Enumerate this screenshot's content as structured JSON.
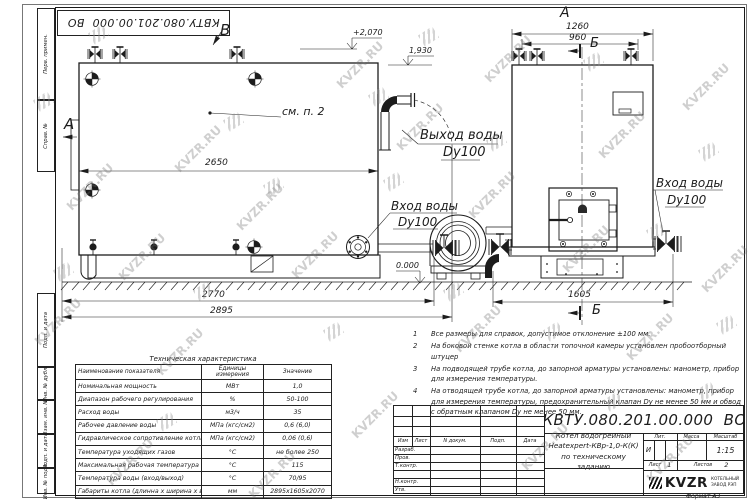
{
  "doc": {
    "number": "КВТУ.080.201.00.000  ВО",
    "format": "Формат  А3"
  },
  "watermark": {
    "text": "KVZR.RU"
  },
  "margin_labels": [
    "Перв. примен.",
    "Справ. №",
    "Подп. и дата",
    "Инв. № дубл.",
    "Взам. инв. №",
    "Подп. и дата",
    "Инв. № подл."
  ],
  "views": {
    "label_a_side": "А",
    "label_b_top": "B",
    "label_a_title": "А",
    "section_b": "Б",
    "see_note": "см. п. 2",
    "outlet": {
      "l1": "Выход воды",
      "l2": "Dy100"
    },
    "inlet_left": {
      "l1": "Вход воды",
      "l2": "Dy100"
    },
    "inlet_right": {
      "l1": "Вход воды",
      "l2": "Dy100"
    },
    "dims": {
      "d2650": "2650",
      "d2770": "2770",
      "d2895": "2895",
      "d1260": "1260",
      "d960": "960",
      "d1605": "1605"
    },
    "elev": {
      "top": "+2,070",
      "roof": "1,930",
      "zero": "0.000"
    }
  },
  "notes": [
    {
      "num": "1",
      "text": "Все размеры для справок, допустимое отклонение  ±100 мм."
    },
    {
      "num": "2",
      "text": "На боковой стенке котла в области топочной камеры установлен пробоотборный штуцер"
    },
    {
      "num": "3",
      "text": "На  подводящей трубе котла, до запорной арматуры установлены: манометр, прибор для измерения температуры."
    },
    {
      "num": "4",
      "text": "На отводящей трубе котла, до запорной арматуры установлены: манометр, прибор для измерения температуры, предохранительный клапан Dу не менее 50 мм и обвод с обратным клапаном Dу не менее 50 мм."
    }
  ],
  "tech_table": {
    "title": "Техническая характеристика",
    "headers": [
      "Наименование показателя",
      "Единицы измерения",
      "Значение"
    ],
    "rows": [
      [
        "Номинальная мощность",
        "МВт",
        "1,0"
      ],
      [
        "Диапазон рабочего регулирования",
        "%",
        "50-100"
      ],
      [
        "Расход воды",
        "м3/ч",
        "35"
      ],
      [
        "Рабочее давление воды",
        "МПа (кгс/см2)",
        "0,6 (6,0)"
      ],
      [
        "Гидравлическое сопротивление котла",
        "МПа (кгс/см2)",
        "0,06 (0,6)"
      ],
      [
        "Температура уходящих газов",
        "°С",
        "не более 250"
      ],
      [
        "Максимальная рабочая температура воды",
        "°С",
        "115"
      ],
      [
        "Температура воды (вход/выход)",
        "°С",
        "70/95"
      ],
      [
        "Габариты котла (длинна х ширина х высота)",
        "мм",
        "2895х1605х2070"
      ]
    ]
  },
  "title_block": {
    "number": "КВТУ.080.201.00.000  ВО",
    "columns": [
      "Изм",
      "Лист",
      "N докум.",
      "Подп.",
      "Дата"
    ],
    "rows": [
      "Разраб.",
      "Пров.",
      "Т.контр.",
      "",
      "Н.контр.",
      "Утв."
    ],
    "name_lines": [
      "Котел водогрейный",
      "Heatexpert-КВр-1,0-К(К)",
      "по техническому заданию"
    ],
    "lit_label": "Лит.",
    "lit_value": "И",
    "mass_label": "Масса",
    "scale_label": "Масштаб",
    "scale_value": "1:15",
    "sheet_label": "Лист",
    "sheet_value": "1",
    "sheets_label": "Листов",
    "sheets_value": "2",
    "company": "KVZR",
    "company_sub1": "КОТЕЛЬНЫЙ",
    "company_sub2": "ЗАВОД РЭП"
  }
}
